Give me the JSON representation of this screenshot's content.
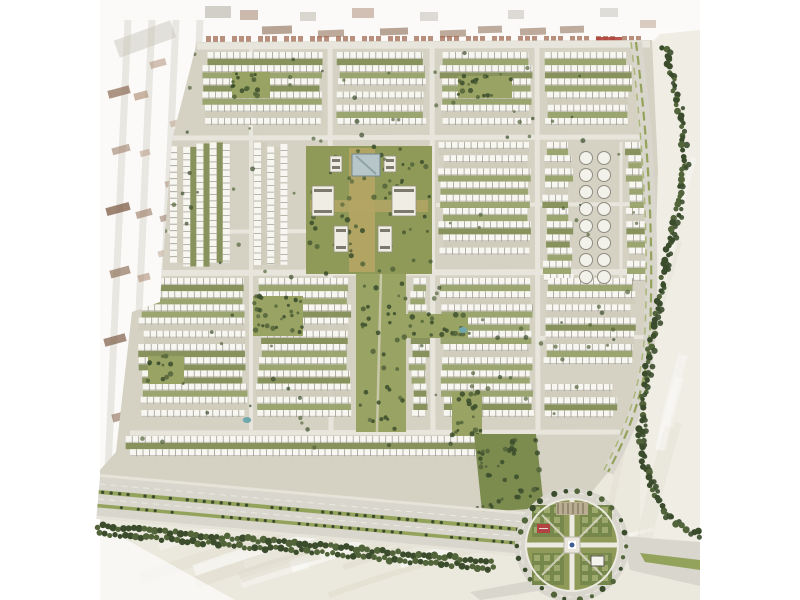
{
  "meta": {
    "description": "Aerial master-plan rendering of a large residential community (rows of white townhouses with green yards), central landscaped park axis, tree-lined boulevard and a circular garden roundabout, surrounded by pale desert; faded existing blocks on the left and top edges. No visible text in the image."
  },
  "palette": {
    "margin": "#ffffff",
    "desert": "#ebe8dd",
    "desertLight": "#f2f0e8",
    "streakLight": "#ffffff",
    "streakDark": "#ded9ca",
    "fadedOverlay": "#ffffff",
    "devGround": "#d5d2c4",
    "street": "#e8e6dc",
    "building": "#f7f6f0",
    "buildingTick": "#8d8a7e",
    "buildingShadow": "#a9a599",
    "yard1": "#94a066",
    "yard2": "#7e8b51",
    "yard3": "#cfccbc",
    "parkGreen": "#8f9a58",
    "parkGreen2": "#99a464",
    "bedGreen": "#77884c",
    "bedLight": "#a8b177",
    "axisGold": "#b4a565",
    "treeDark": "#3a4c2c",
    "treeMid": "#52643a",
    "medianGreen": "#94a35c",
    "roadGray": "#d9d6cd",
    "sidewalk": "#e6e3d9",
    "poolBlue": "#6fa7ac",
    "landmarkTeal": "#b7c6c9",
    "landmarkEdge": "#73878e",
    "bigBldg": "#efede4",
    "bigBldgEdge": "#95917f",
    "bigBldgMark": "#5f5b50",
    "rust": "#9b6048",
    "rustRed": "#b0423a",
    "plazaBlue": "#3d5c94",
    "redFeature": "#b24343",
    "villaFill": "#f2f1ea",
    "villaEdge": "#8f8c80"
  },
  "canvas": {
    "width": 800,
    "height": 600,
    "content_left": 100,
    "content_right": 700
  },
  "development": {
    "outline": [
      [
        197,
        42
      ],
      [
        652,
        40
      ],
      [
        658,
        170
      ],
      [
        654,
        300
      ],
      [
        636,
        420
      ],
      [
        610,
        470
      ],
      [
        590,
        494
      ],
      [
        545,
        517
      ],
      [
        100,
        477
      ],
      [
        100,
        470
      ],
      [
        116,
        452
      ],
      [
        132,
        312
      ],
      [
        160,
        302
      ],
      [
        172,
        140
      ]
    ]
  },
  "streets": {
    "segments": [
      [
        197,
        46,
        650,
        44,
        7
      ],
      [
        172,
        138,
        648,
        137,
        5
      ],
      [
        160,
        273,
        656,
        272,
        6
      ],
      [
        436,
        205,
        654,
        204,
        4
      ],
      [
        168,
        232,
        326,
        231,
        4
      ],
      [
        540,
        338,
        650,
        337,
        4
      ],
      [
        130,
        433,
        620,
        432,
        5
      ],
      [
        251,
        45,
        251,
        430,
        4
      ],
      [
        330,
        45,
        331,
        434,
        5
      ],
      [
        432,
        45,
        433,
        434,
        5
      ],
      [
        537,
        45,
        538,
        434,
        5
      ],
      [
        621,
        142,
        621,
        292,
        3
      ]
    ]
  },
  "housing_blocks": [
    [
      202,
      52,
      122,
      80,
      "h"
    ],
    [
      336,
      52,
      92,
      80,
      "h"
    ],
    [
      438,
      52,
      95,
      80,
      "h"
    ],
    [
      544,
      52,
      88,
      80,
      "h"
    ],
    [
      170,
      142,
      78,
      126,
      "v"
    ],
    [
      254,
      142,
      52,
      126,
      "v"
    ],
    [
      438,
      142,
      95,
      126,
      "h"
    ],
    [
      542,
      142,
      32,
      152,
      "h"
    ],
    [
      624,
      142,
      28,
      148,
      "h"
    ],
    [
      138,
      278,
      110,
      150,
      "h"
    ],
    [
      256,
      278,
      96,
      150,
      "h"
    ],
    [
      408,
      278,
      22,
      150,
      "h"
    ],
    [
      438,
      278,
      96,
      150,
      "h"
    ],
    [
      542,
      278,
      94,
      100,
      "h"
    ],
    [
      542,
      384,
      76,
      46,
      "h"
    ],
    [
      124,
      436,
      412,
      32,
      "h"
    ]
  ],
  "parks": {
    "pockets": [
      [
        232,
        72,
        38,
        26
      ],
      [
        458,
        76,
        54,
        22
      ],
      [
        253,
        296,
        50,
        40
      ],
      [
        148,
        356,
        36,
        28
      ],
      [
        400,
        314,
        68,
        24
      ],
      [
        452,
        392,
        30,
        44
      ]
    ],
    "wedge": [
      [
        474,
        434
      ],
      [
        536,
        434
      ],
      [
        544,
        508
      ],
      [
        482,
        512
      ]
    ],
    "central": {
      "rect": [
        306,
        146,
        126,
        128
      ],
      "axis_v": [
        349,
        148,
        26,
        124
      ],
      "axis_h": [
        310,
        200,
        118,
        12
      ]
    },
    "south_axis": {
      "rect": [
        356,
        274,
        50,
        158
      ]
    }
  },
  "buildings": {
    "landmark": [
      352,
      154,
      28,
      22
    ],
    "large": [
      [
        312,
        186,
        22,
        30
      ],
      [
        392,
        186,
        24,
        30
      ],
      [
        330,
        156,
        12,
        16
      ],
      [
        384,
        156,
        12,
        16
      ],
      [
        334,
        226,
        14,
        26
      ],
      [
        378,
        226,
        14,
        26
      ]
    ]
  },
  "round_villas": {
    "columns": [
      586,
      604
    ],
    "y_start": 158,
    "y_end": 292,
    "step": 17,
    "r": 6.5
  },
  "pools": [
    [
      463,
      330
    ],
    [
      247,
      420
    ]
  ],
  "right_road": {
    "path": "M636,42 C648,140 654,240 650,330 C646,390 630,430 608,472"
  },
  "tree_line": {
    "points": [
      [
        664,
        46
      ],
      [
        672,
        80
      ],
      [
        681,
        120
      ],
      [
        685,
        160
      ],
      [
        679,
        205
      ],
      [
        668,
        250
      ],
      [
        659,
        300
      ],
      [
        650,
        350
      ],
      [
        643,
        400
      ],
      [
        640,
        440
      ],
      [
        646,
        470
      ],
      [
        655,
        495
      ],
      [
        664,
        512
      ],
      [
        678,
        524
      ],
      [
        692,
        531
      ],
      [
        700,
        534
      ]
    ]
  },
  "boulevard": {
    "x": 100,
    "y": 477,
    "angle": 5.1,
    "length": 475,
    "tree_band_length": 400
  },
  "roundabout": {
    "cx": 572,
    "cy": 545,
    "outer_r": 57,
    "garden_r": 46,
    "red_feature": [
      537,
      524,
      13,
      9
    ],
    "pavilion": [
      591,
      556,
      13,
      10
    ],
    "pergola": [
      556,
      502,
      32,
      13
    ]
  },
  "exit_roads": {
    "right": [
      [
        622,
        536
      ],
      [
        700,
        542
      ],
      [
        700,
        586
      ],
      [
        630,
        570
      ]
    ],
    "right_median": [
      [
        640,
        553
      ],
      [
        700,
        560
      ],
      [
        700,
        570
      ],
      [
        645,
        562
      ]
    ],
    "south": [
      [
        560,
        594
      ],
      [
        584,
        592
      ],
      [
        586,
        600
      ],
      [
        558,
        600
      ]
    ],
    "southwest": [
      [
        534,
        580
      ],
      [
        544,
        590
      ],
      [
        480,
        600
      ],
      [
        470,
        592
      ]
    ]
  },
  "faded_zone": {
    "outline": [
      [
        100,
        0
      ],
      [
        700,
        0
      ],
      [
        700,
        30
      ],
      [
        660,
        34
      ],
      [
        652,
        42
      ],
      [
        197,
        42
      ],
      [
        172,
        140
      ],
      [
        160,
        302
      ],
      [
        132,
        312
      ],
      [
        116,
        452
      ],
      [
        100,
        470
      ]
    ],
    "opacity": 0.78,
    "blocks": [
      [
        108,
        88,
        22,
        8,
        -15,
        "#8a6a52",
        0.7
      ],
      [
        134,
        92,
        14,
        7,
        -15,
        "#a8856d",
        0.6
      ],
      [
        112,
        146,
        18,
        7,
        -15,
        "#96755d",
        0.55
      ],
      [
        140,
        150,
        10,
        6,
        -15,
        "#b29279",
        0.5
      ],
      [
        106,
        205,
        24,
        8,
        -15,
        "#7d5c47",
        0.75
      ],
      [
        136,
        210,
        16,
        7,
        -15,
        "#9a7860",
        0.6
      ],
      [
        160,
        215,
        10,
        6,
        -15,
        "#8a6a52",
        0.5
      ],
      [
        110,
        268,
        20,
        8,
        -15,
        "#8a6a52",
        0.65
      ],
      [
        138,
        274,
        12,
        7,
        -15,
        "#a8856d",
        0.55
      ],
      [
        104,
        336,
        22,
        8,
        -15,
        "#7d5c47",
        0.7
      ],
      [
        132,
        342,
        14,
        7,
        -15,
        "#96755d",
        0.55
      ],
      [
        112,
        412,
        20,
        8,
        -15,
        "#8a6a52",
        0.6
      ],
      [
        140,
        418,
        12,
        6,
        -15,
        "#a8856d",
        0.5
      ],
      [
        108,
        470,
        24,
        8,
        -15,
        "#96755d",
        0.55
      ],
      [
        150,
        60,
        16,
        7,
        -15,
        "#a8856d",
        0.5
      ],
      [
        170,
        120,
        12,
        6,
        -15,
        "#b29279",
        0.45
      ],
      [
        165,
        180,
        14,
        6,
        -15,
        "#a8856d",
        0.5
      ],
      [
        158,
        250,
        12,
        6,
        -15,
        "#b29279",
        0.45
      ],
      [
        152,
        310,
        14,
        7,
        -15,
        "#a8856d",
        0.5
      ],
      [
        144,
        380,
        12,
        6,
        -15,
        "#b29279",
        0.45
      ],
      [
        115,
        30,
        60,
        18,
        -20,
        "#c9c5bb",
        0.5
      ],
      [
        150,
        330,
        50,
        14,
        -20,
        "#cdc9bf",
        0.4
      ],
      [
        205,
        6,
        26,
        12,
        0,
        "#b7b2a8",
        0.6
      ],
      [
        240,
        10,
        18,
        10,
        0,
        "#9a7860",
        0.5
      ],
      [
        262,
        26,
        30,
        8,
        -2,
        "#8a6a52",
        0.6
      ],
      [
        300,
        12,
        16,
        9,
        0,
        "#b7b2a8",
        0.5
      ],
      [
        318,
        30,
        26,
        7,
        -2,
        "#96755d",
        0.6
      ],
      [
        352,
        8,
        22,
        10,
        0,
        "#a8856d",
        0.5
      ],
      [
        380,
        28,
        28,
        7,
        -2,
        "#8a6a52",
        0.6
      ],
      [
        420,
        12,
        18,
        9,
        0,
        "#b7b2a8",
        0.45
      ],
      [
        440,
        30,
        26,
        7,
        -2,
        "#96755d",
        0.6
      ],
      [
        478,
        26,
        24,
        7,
        -2,
        "#8a6a52",
        0.55
      ],
      [
        508,
        10,
        16,
        9,
        0,
        "#b7b2a8",
        0.45
      ],
      [
        520,
        28,
        26,
        7,
        -2,
        "#96755d",
        0.6
      ],
      [
        560,
        26,
        24,
        7,
        -2,
        "#8a6a52",
        0.55
      ],
      [
        600,
        8,
        18,
        9,
        0,
        "#b7b2a8",
        0.4
      ],
      [
        640,
        20,
        16,
        8,
        0,
        "#a8856d",
        0.4
      ]
    ]
  },
  "top_row": {
    "x_start": 206,
    "x_end": 628,
    "step": 26,
    "dash_w": 5,
    "dash_h": 7,
    "y": 36,
    "rust_block": [
      596,
      37,
      26,
      8
    ]
  }
}
